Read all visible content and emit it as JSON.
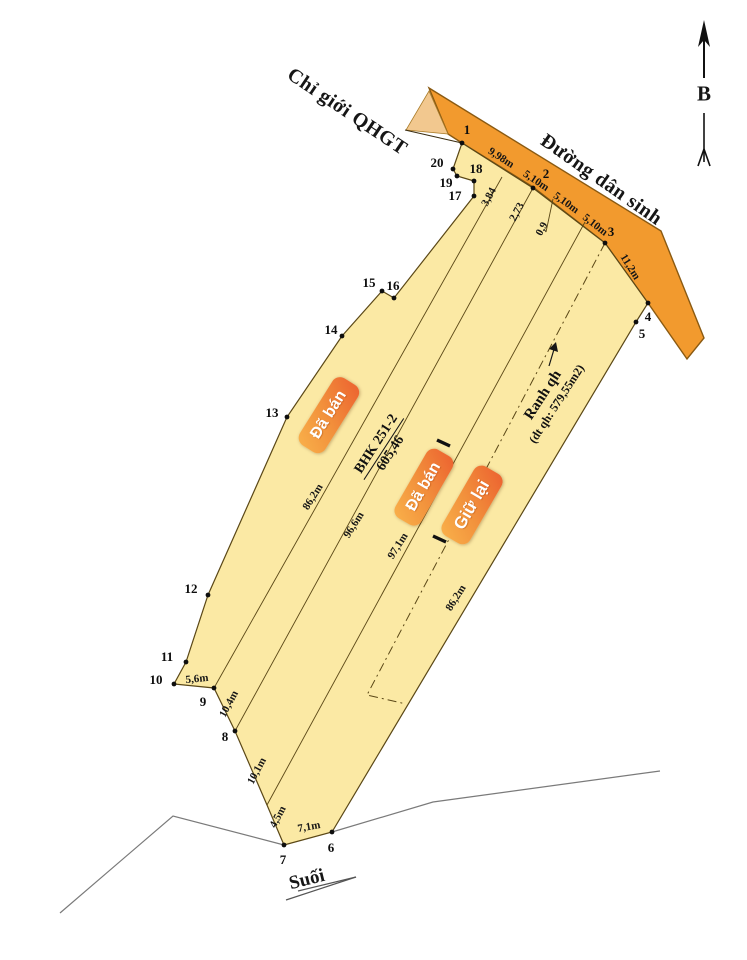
{
  "map": {
    "north_label": "B",
    "road_name": "Đường dân sinh",
    "planning_boundary_label": "Chỉ giới QHGT",
    "stream_label": "Suối",
    "parcel": {
      "land_use_code": "BHK 251-2",
      "area": "605,46"
    },
    "planning_area": {
      "label": "Ranh qh",
      "detail": "(dt qh: 579,55m2)"
    },
    "badges": {
      "sold_1": "Đã bán",
      "sold_2": "Đã bán",
      "keep": "Giữ lại"
    }
  },
  "measurements": {
    "frontage_1": "9,98m",
    "frontage_2": "5,10m",
    "frontage_3": "5,10m",
    "frontage_4": "5,10m",
    "road_edge": "11,2m",
    "offset_1": "3,84",
    "offset_2": "2,73",
    "offset_3": "0,9",
    "strip_left": "86,2m",
    "strip_2": "96,6m",
    "strip_3": "97,1m",
    "strip_right": "86,2m",
    "edge_9_10": "5,6m",
    "edge_8_9": "10,4m",
    "edge_bend_8": "10,1m",
    "edge_7_bend": "4,5m",
    "edge_6_7": "7,1m"
  },
  "vertices": [
    "1",
    "2",
    "3",
    "4",
    "5",
    "6",
    "7",
    "8",
    "9",
    "10",
    "11",
    "12",
    "13",
    "14",
    "15",
    "16",
    "17",
    "18",
    "19",
    "20"
  ]
}
